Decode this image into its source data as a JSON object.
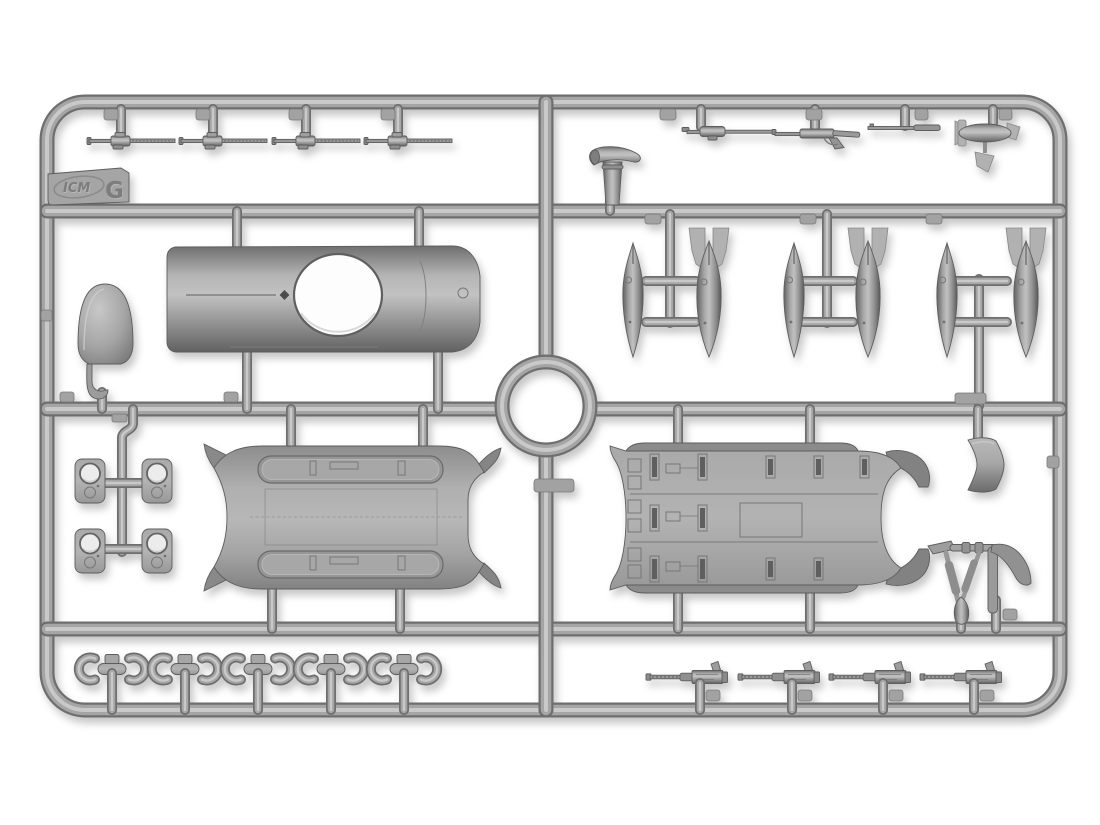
{
  "scene": {
    "type": "photograph",
    "subject": "Gray injection-molded plastic model kit sprue (parts frame) photographed on a white background",
    "tag": {
      "brand_logo": "ICM",
      "sprue_letter": "G"
    },
    "colors": {
      "background": "#ffffff",
      "plastic_mid": "#a3a3a3",
      "plastic_highlight": "#c9c9c9",
      "plastic_shadow": "#6e6e6e",
      "drop_shadow": "rgba(0,0,0,0.22)"
    },
    "frame": {
      "shape": "rounded rectangle",
      "inner_runner_rows": 4,
      "center_junction": "circular ring"
    },
    "part_groups": [
      {
        "name": "slim aircraft machine gun",
        "count": 4,
        "location": "top row, left"
      },
      {
        "name": "flexible machine gun",
        "count": 2,
        "location": "top row, right"
      },
      {
        "name": "gun barrel rod",
        "count": 1,
        "location": "top row, right"
      },
      {
        "name": "small bomb with cruciform fins",
        "count": 1,
        "location": "top row, far right"
      },
      {
        "name": "venturi air scoop",
        "count": 1,
        "location": "upper middle, right of center"
      },
      {
        "name": "cowling dome",
        "count": 1,
        "location": "second row, far left"
      },
      {
        "name": "hook bracket",
        "count": 1,
        "location": "below cowling dome"
      },
      {
        "name": "fuselage mid-section with round turret opening",
        "count": 1,
        "location": "second row, left"
      },
      {
        "name": "drop-tank half",
        "count": 3,
        "location": "second row, right"
      },
      {
        "name": "bomb with box tail fins",
        "count": 3,
        "location": "second row, right"
      },
      {
        "name": "hatch plate with round hole",
        "count": 4,
        "location": "third row, far left"
      },
      {
        "name": "hull underside with twin recesses",
        "count": 1,
        "location": "third row, left"
      },
      {
        "name": "cabin floor deck panel",
        "count": 1,
        "location": "third row, right"
      },
      {
        "name": "curved cowl band",
        "count": 1,
        "location": "third row, far right"
      },
      {
        "name": "gun-mount yoke with curved arm",
        "count": 1,
        "location": "third row, far right"
      },
      {
        "name": "C-shaped clamp bracket",
        "count": 10,
        "location": "bottom row, left"
      },
      {
        "name": "T-shaped clamp spacer",
        "count": 5,
        "location": "bottom row, left"
      },
      {
        "name": "Browning M2 machine gun",
        "count": 4,
        "location": "bottom row, right"
      }
    ]
  }
}
